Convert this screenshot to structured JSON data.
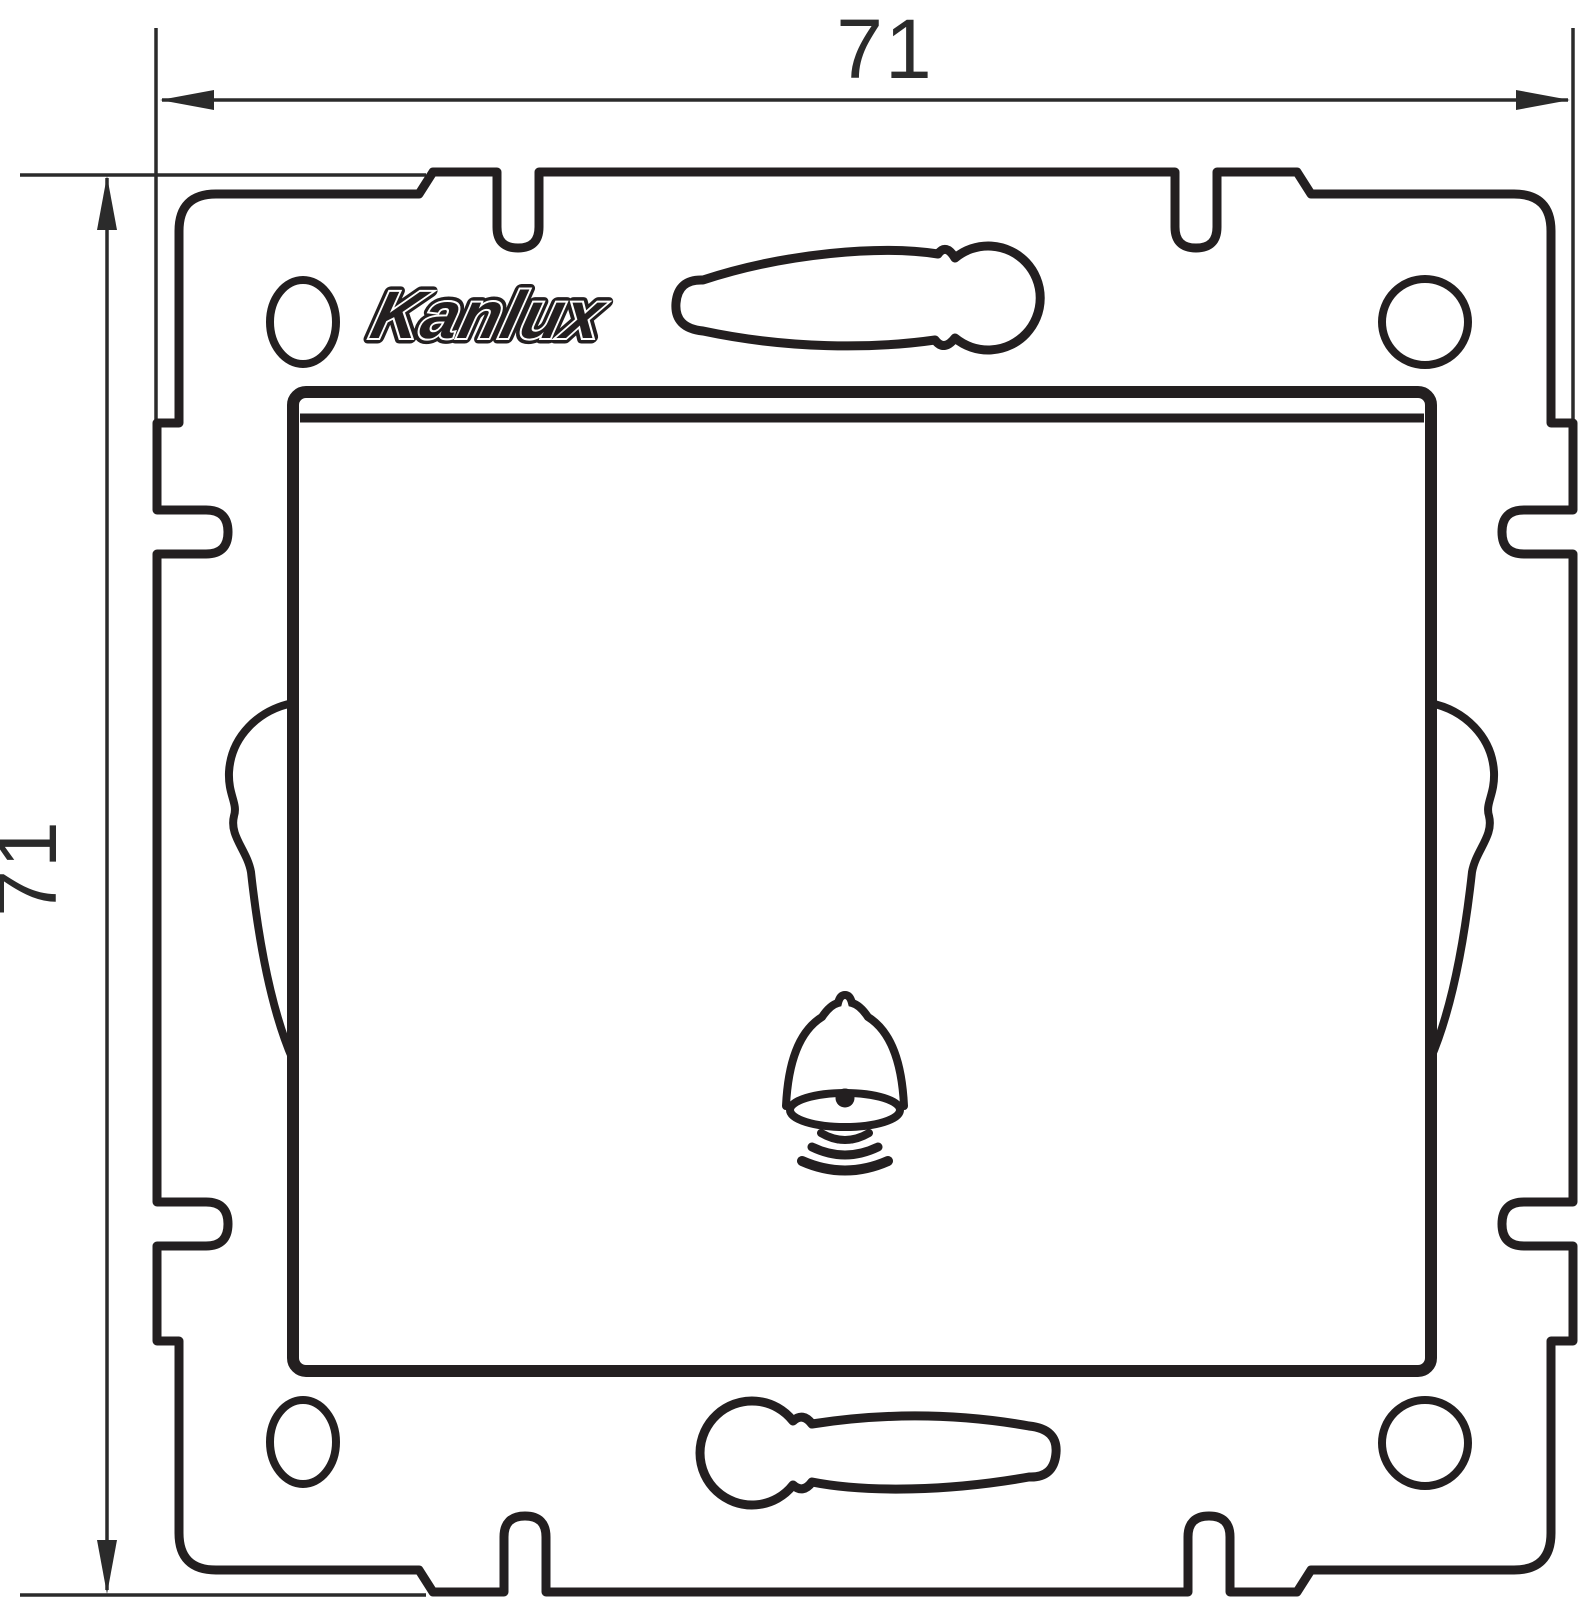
{
  "drawing": {
    "brand_logo": "Kanlux",
    "dimension_width": "71",
    "dimension_height": "71",
    "colors": {
      "outline": "#231f20",
      "dimension_lines": "#2b2b2b",
      "background": "#ffffff"
    },
    "icons": {
      "center_symbol": "doorbell-bell-icon"
    },
    "parts": {
      "plate": "mounting-frame-plate",
      "opening": "switch-button-opening",
      "holes": "screw-hole",
      "slots": "adjustment-slot",
      "clips": "spring-claw"
    }
  }
}
